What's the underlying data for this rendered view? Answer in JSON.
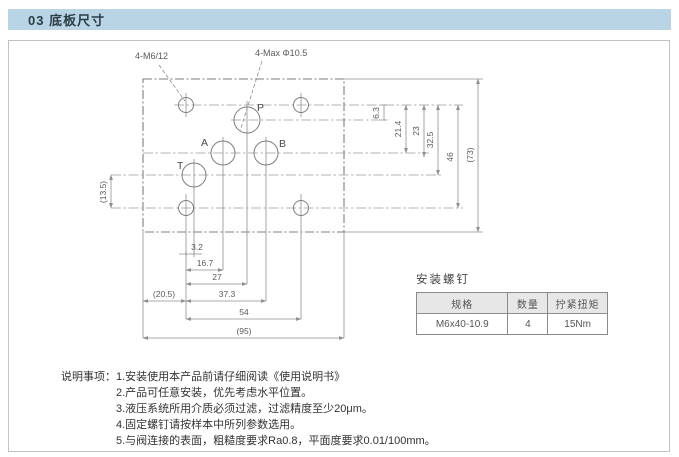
{
  "header": {
    "title": "03 底板尺寸"
  },
  "drawing": {
    "callouts": {
      "mounting_thread": "4-M6/12",
      "max_port_dia": "4-Max Φ10.5"
    },
    "ports": {
      "p": "P",
      "a": "A",
      "b": "B",
      "t": "T"
    },
    "dims_horizontal": [
      "3.2",
      "16.7",
      "27",
      "(20.5)",
      "37.3",
      "54",
      "(95)"
    ],
    "dims_vertical": [
      "6.3",
      "21.4",
      "23",
      "32.5",
      "46",
      "(73)"
    ],
    "dim_left": "(13.5)"
  },
  "screw_table": {
    "title": "安装螺钉",
    "headers": [
      "规格",
      "数量",
      "拧紧扭矩"
    ],
    "row": [
      "M6x40-10.9",
      "4",
      "15Nm"
    ]
  },
  "notes": {
    "label": "说明事项：",
    "items": [
      "1.安装使用本产品前请仔细阅读《使用说明书》",
      "2.产品可任意安装，优先考虑水平位置。",
      "3.液压系统所用介质必须过滤，过滤精度至少20μm。",
      "4.固定螺钉请按样本中所列参数选用。",
      "5.与阀连接的表面，粗糙度要求Ra0.8，平面度要求0.01/100mm。"
    ]
  },
  "colors": {
    "header_bg": "#b9d4e4",
    "line": "#8a8a8a",
    "accent_text": "#2a3c46"
  }
}
